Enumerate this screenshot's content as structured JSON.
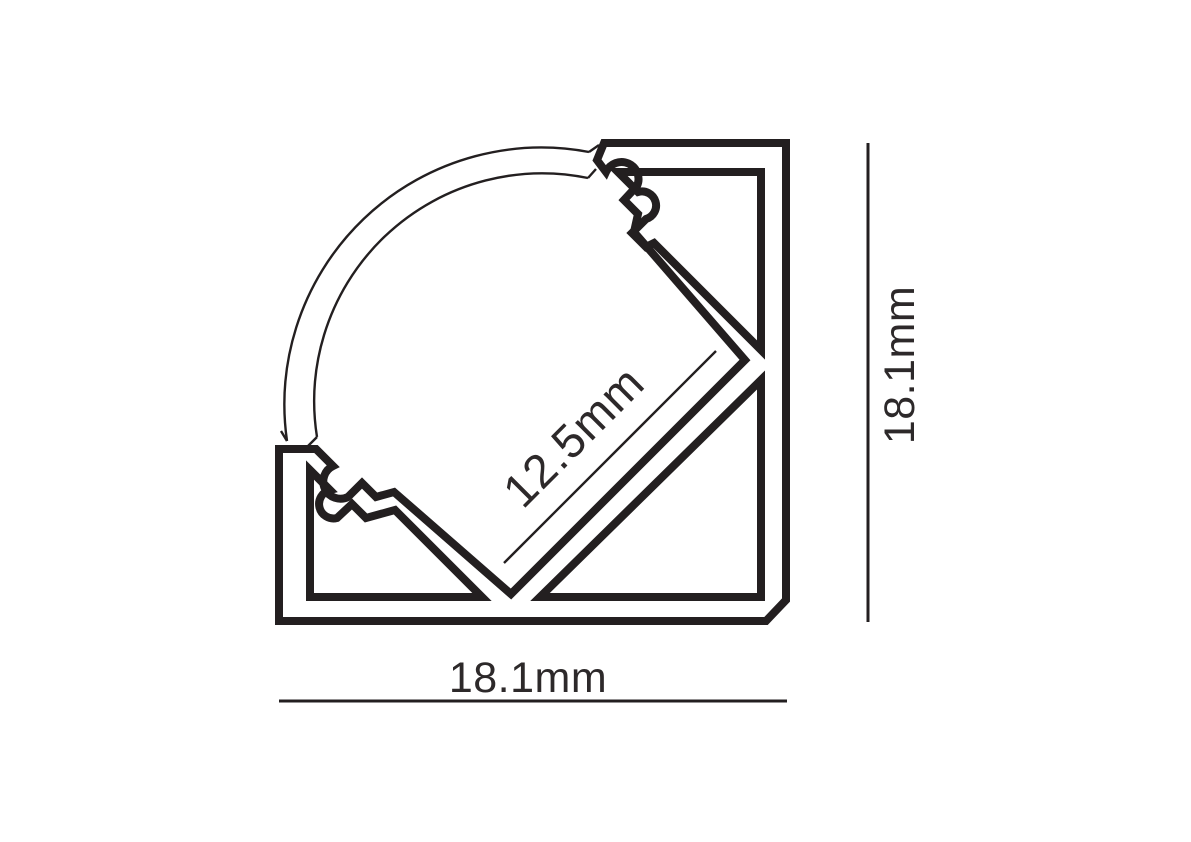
{
  "diagram": {
    "type": "technical-drawing",
    "subject": "45-degree corner LED aluminium profile cross-section with curved diffuser cover",
    "ink_color": "#231f20",
    "background_color": "#ffffff",
    "dimensions": {
      "inner_channel": {
        "label": "12.5mm",
        "orientation": "diagonal-45deg"
      },
      "overall_width": {
        "label": "18.1mm",
        "orientation": "horizontal-bottom"
      },
      "overall_height": {
        "label": "18.1mm",
        "orientation": "vertical-right"
      }
    }
  }
}
